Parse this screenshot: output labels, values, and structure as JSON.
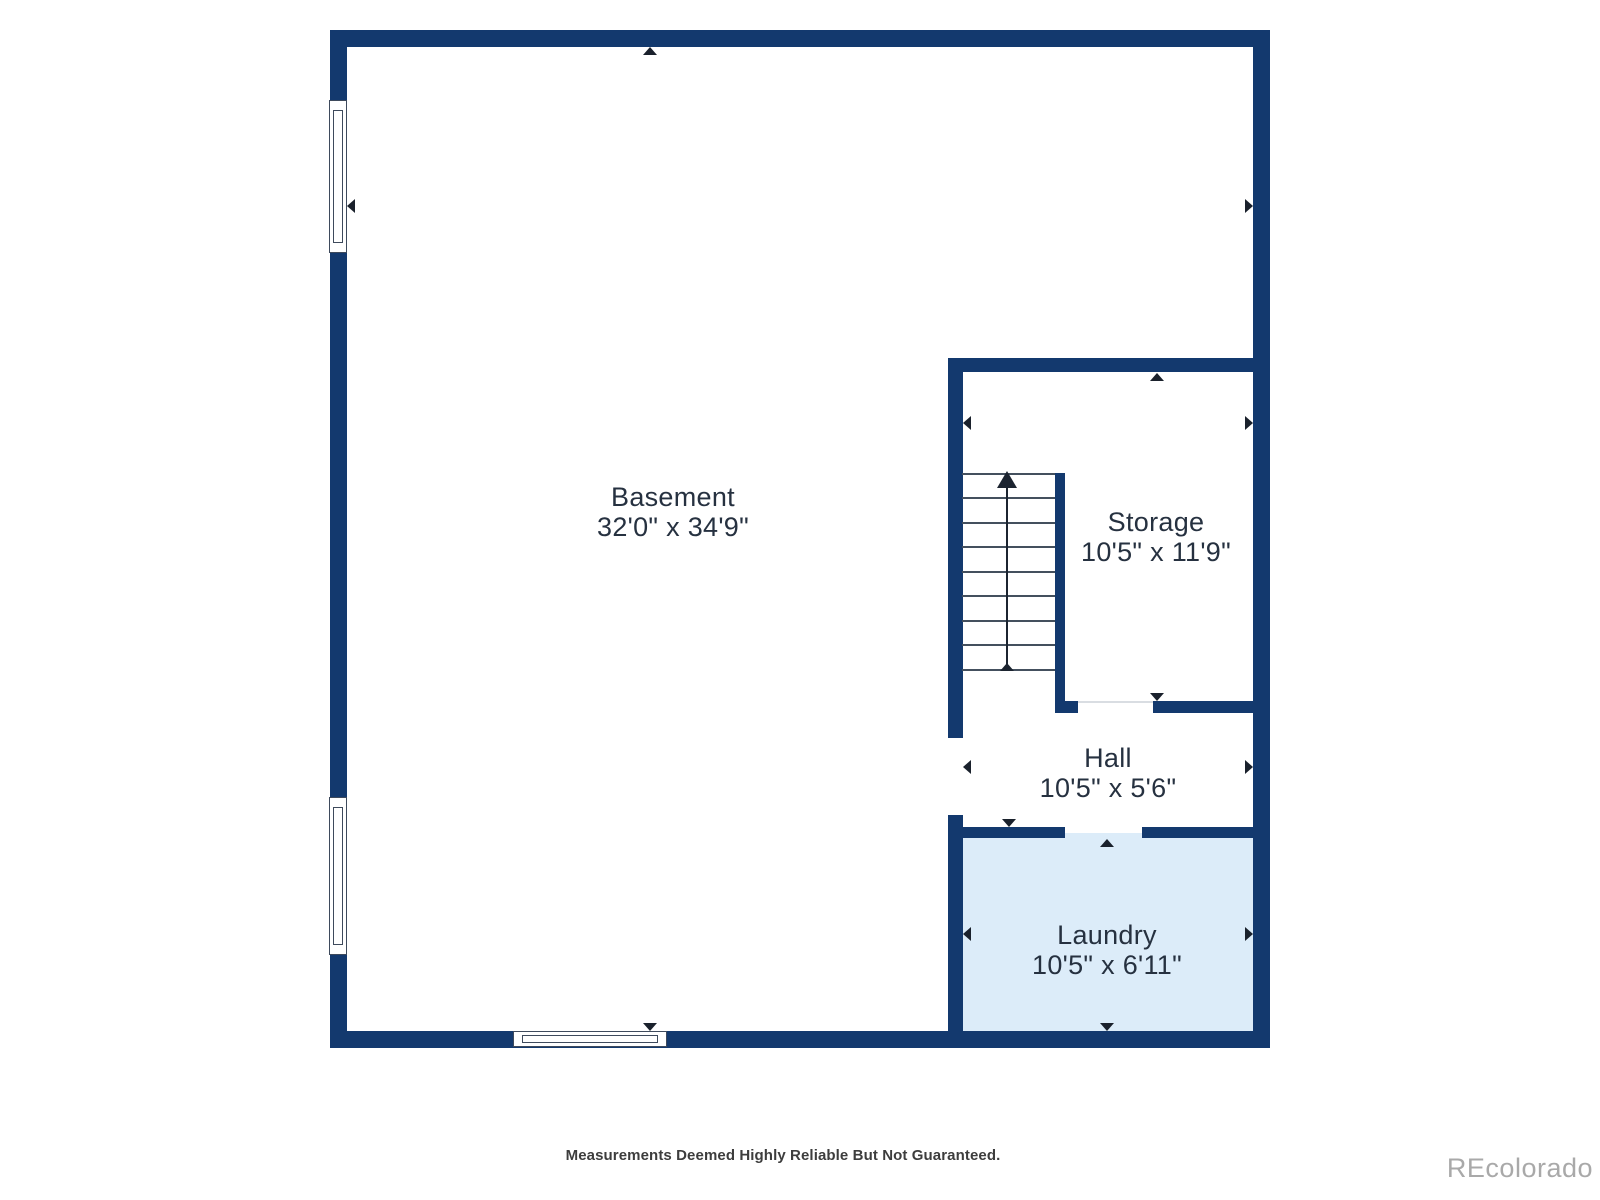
{
  "page": {
    "width": 1600,
    "height": 1200,
    "background": "#ffffff"
  },
  "colors": {
    "wall": "#13396e",
    "laundry_fill": "#dcecf9",
    "label_text": "#263140",
    "dim_arrow": "#1a212c",
    "window_border": "#3e4a5c",
    "tread_line": "#44505e",
    "stair_line": "#1c2430",
    "threshold": "#d9dde2",
    "disclaimer_text": "#3d3d3d",
    "watermark_text": "#a9a9a9"
  },
  "footer": {
    "disclaimer": "Measurements Deemed Highly Reliable But Not Guaranteed."
  },
  "watermark": {
    "text": "REcolorado"
  },
  "floorplan": {
    "rooms": [
      {
        "id": "basement",
        "name": "Basement",
        "dims": "32'0\" x 34'9\"",
        "cx": 673,
        "cy": 512
      },
      {
        "id": "storage",
        "name": "Storage",
        "dims": "10'5\" x 11'9\"",
        "cx": 1156,
        "cy": 537
      },
      {
        "id": "hall",
        "name": "Hall",
        "dims": "10'5\" x 5'6\"",
        "cx": 1108,
        "cy": 773
      },
      {
        "id": "laundry",
        "name": "Laundry",
        "dims": "10'5\" x 6'11\"",
        "cx": 1107,
        "cy": 950
      }
    ],
    "fills": [
      {
        "name": "laundry-floor",
        "x": 958,
        "y": 833,
        "w": 300,
        "h": 202,
        "color": "#dcecf9"
      }
    ],
    "walls": [
      {
        "name": "wall-outer-top",
        "x": 330,
        "y": 30,
        "w": 940,
        "h": 17
      },
      {
        "name": "wall-outer-left",
        "x": 330,
        "y": 30,
        "w": 17,
        "h": 1018
      },
      {
        "name": "wall-outer-right",
        "x": 1253,
        "y": 30,
        "w": 17,
        "h": 1018
      },
      {
        "name": "wall-outer-bottom",
        "x": 330,
        "y": 1031,
        "w": 940,
        "h": 17
      },
      {
        "name": "wall-storage-top",
        "x": 948,
        "y": 358,
        "w": 305,
        "h": 14
      },
      {
        "name": "wall-divider-upper",
        "x": 948,
        "y": 358,
        "w": 15,
        "h": 380
      },
      {
        "name": "wall-laundry-left",
        "x": 948,
        "y": 815,
        "w": 15,
        "h": 216
      },
      {
        "name": "wall-stair-right",
        "x": 1055,
        "y": 473,
        "w": 10,
        "h": 240
      },
      {
        "name": "wall-stair-stub",
        "x": 1055,
        "y": 701,
        "w": 23,
        "h": 12
      },
      {
        "name": "wall-storage-hall-right",
        "x": 1153,
        "y": 701,
        "w": 100,
        "h": 12
      },
      {
        "name": "wall-hall-laundry-left",
        "x": 948,
        "y": 827,
        "w": 117,
        "h": 11
      },
      {
        "name": "wall-hall-laundry-right",
        "x": 1142,
        "y": 827,
        "w": 111,
        "h": 11
      }
    ],
    "thresholds": [
      {
        "name": "threshold-storage-hall",
        "x": 1078,
        "y": 701,
        "w": 75
      }
    ],
    "windows": [
      {
        "name": "window-left-upper",
        "dir": "v",
        "x": 329,
        "y": 100,
        "w": 18,
        "h": 153
      },
      {
        "name": "window-left-lower",
        "dir": "v",
        "x": 329,
        "y": 797,
        "w": 18,
        "h": 158
      },
      {
        "name": "window-bottom",
        "dir": "h",
        "x": 513,
        "y": 1031,
        "w": 154,
        "h": 16
      }
    ],
    "stairs": {
      "treads_x1": 962,
      "treads_x2": 1055,
      "tread_ys": [
        473,
        497,
        522,
        546,
        571,
        595,
        620,
        644,
        669
      ],
      "line_x": 1007,
      "line_y1": 478,
      "line_y2": 671,
      "arrow_big": {
        "x": 1007,
        "y": 471,
        "across": 20,
        "depth": 17
      },
      "arrow_small": {
        "x": 1007,
        "y": 663,
        "across": 14,
        "depth": 8
      }
    },
    "dim_arrows": [
      {
        "name": "basement-dim-up",
        "dir": "up",
        "x": 650,
        "y": 47
      },
      {
        "name": "basement-dim-down",
        "dir": "down",
        "x": 650,
        "y": 1031
      },
      {
        "name": "basement-dim-left",
        "dir": "left",
        "x": 347,
        "y": 206
      },
      {
        "name": "basement-dim-right",
        "dir": "right",
        "x": 1253,
        "y": 206
      },
      {
        "name": "storage-dim-left",
        "dir": "left",
        "x": 963,
        "y": 423
      },
      {
        "name": "storage-dim-right",
        "dir": "right",
        "x": 1253,
        "y": 423
      },
      {
        "name": "storage-dim-up",
        "dir": "up",
        "x": 1157,
        "y": 373
      },
      {
        "name": "storage-dim-down",
        "dir": "down",
        "x": 1157,
        "y": 701
      },
      {
        "name": "hall-dim-left",
        "dir": "left",
        "x": 963,
        "y": 767
      },
      {
        "name": "hall-dim-right",
        "dir": "right",
        "x": 1253,
        "y": 767
      },
      {
        "name": "hall-dim-down",
        "dir": "down",
        "x": 1009,
        "y": 827
      },
      {
        "name": "laundry-dim-up",
        "dir": "up",
        "x": 1107,
        "y": 839
      },
      {
        "name": "laundry-dim-down",
        "dir": "down",
        "x": 1107,
        "y": 1031
      },
      {
        "name": "laundry-dim-left",
        "dir": "left",
        "x": 963,
        "y": 934
      },
      {
        "name": "laundry-dim-right",
        "dir": "right",
        "x": 1253,
        "y": 934
      }
    ]
  }
}
